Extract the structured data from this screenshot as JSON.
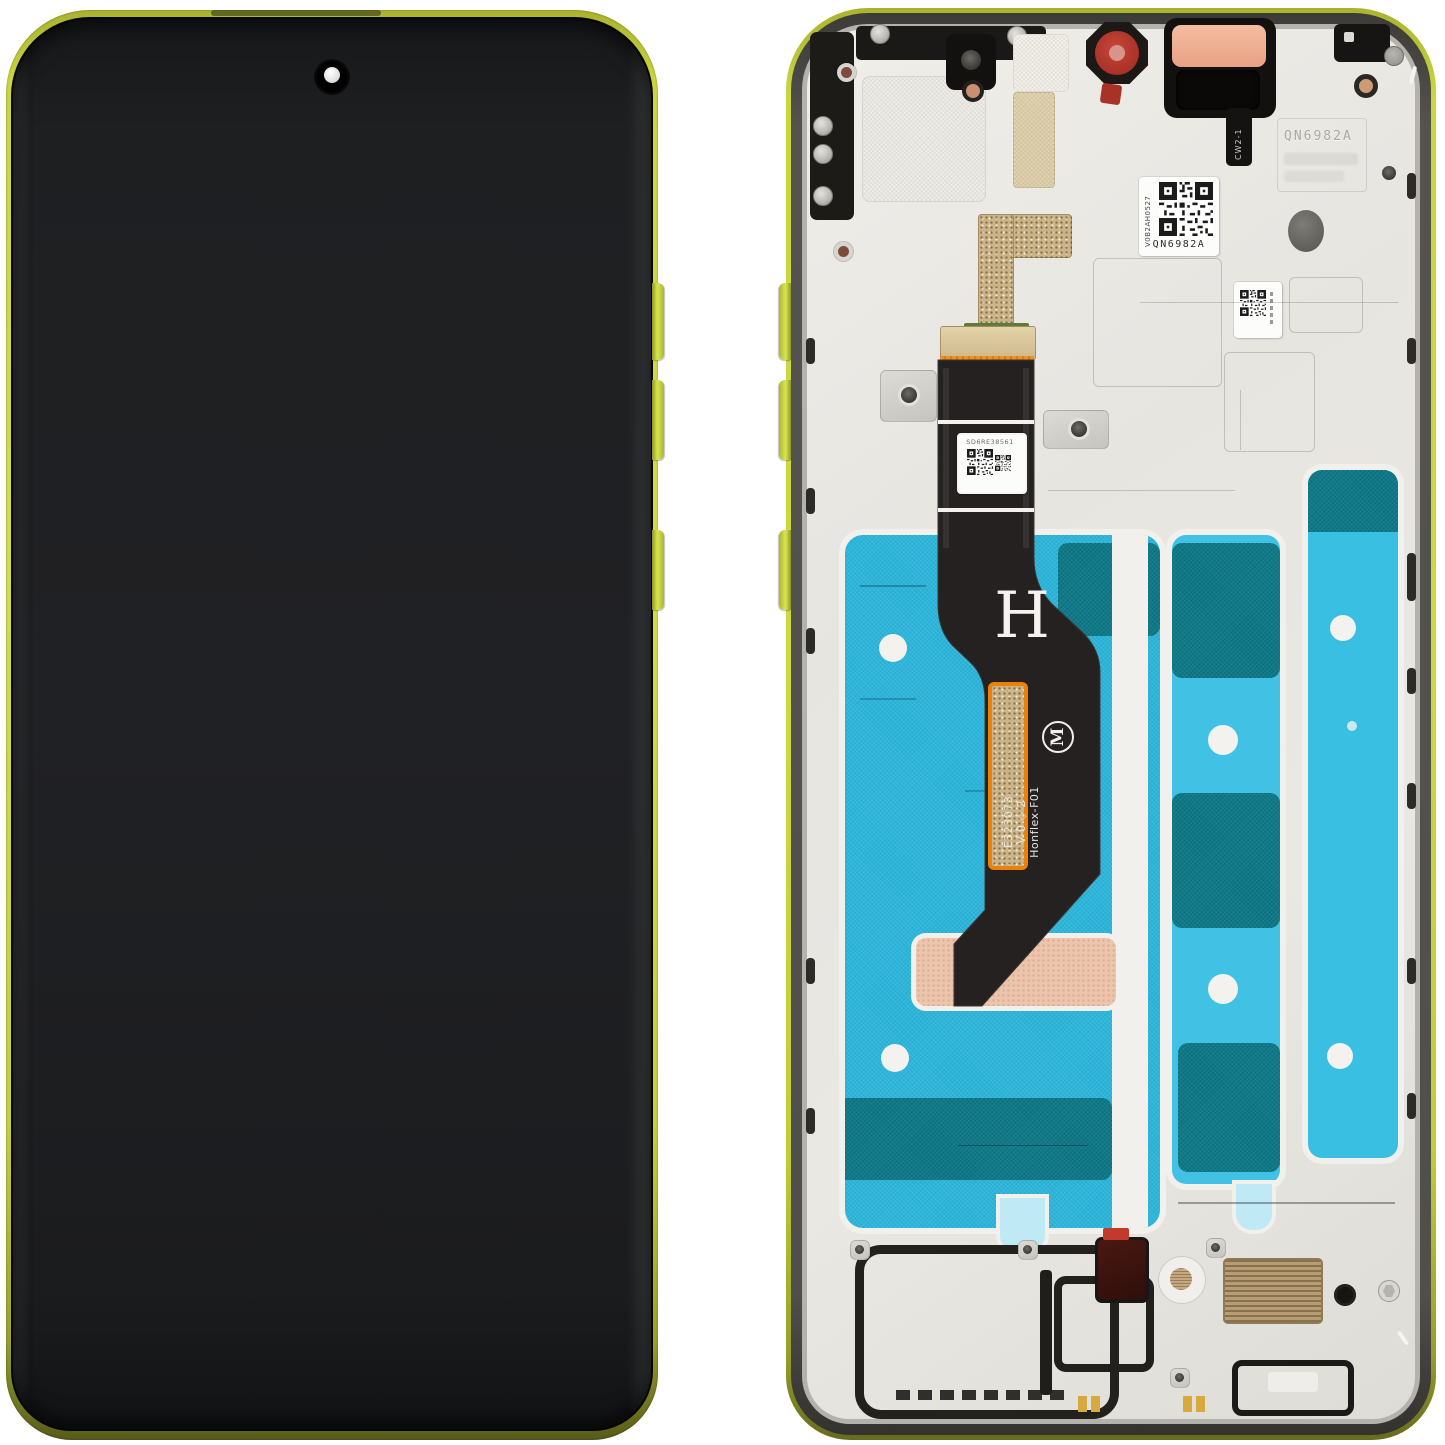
{
  "scene": {
    "type": "product-photo",
    "subject": "smartphone display assembly front and back views",
    "background_color": "#ffffff"
  },
  "colors": {
    "frame_lime": "#c9d63f",
    "frame_dark_edge": "#6b7020",
    "screen_black": "#1e1f21",
    "rim_gray": "#504f4a",
    "chassis_light": "#e9e7e2",
    "adhesive_blue": "#2cb5da",
    "adhesive_blue_bright": "#41c2e4",
    "adhesive_teal": "#0f7a88",
    "flex_black": "#242120",
    "connector_orange": "#ef9120",
    "connector_tan": "#d8c49a",
    "pcb_green": "#5d7c36",
    "pad_pink": "#ecc5ac",
    "pad_peach": "#f2b49a",
    "gasket_red": "#b43528",
    "bronze": "#b99d72"
  },
  "back_view": {
    "flex": {
      "letter_marking": "H",
      "part_line1": "E323073",
      "part_line2": "V-0 ◇ 2",
      "part_line3": "Honflex-F01",
      "label_code": "SD6RE38561"
    },
    "qr_label": {
      "code_text": "QN6982A",
      "side_text": "V0B2AH0527"
    },
    "embossed_text": "QN6982A",
    "bracket_marking": "CW2-1"
  },
  "icons": {
    "motorola_m": "M"
  }
}
